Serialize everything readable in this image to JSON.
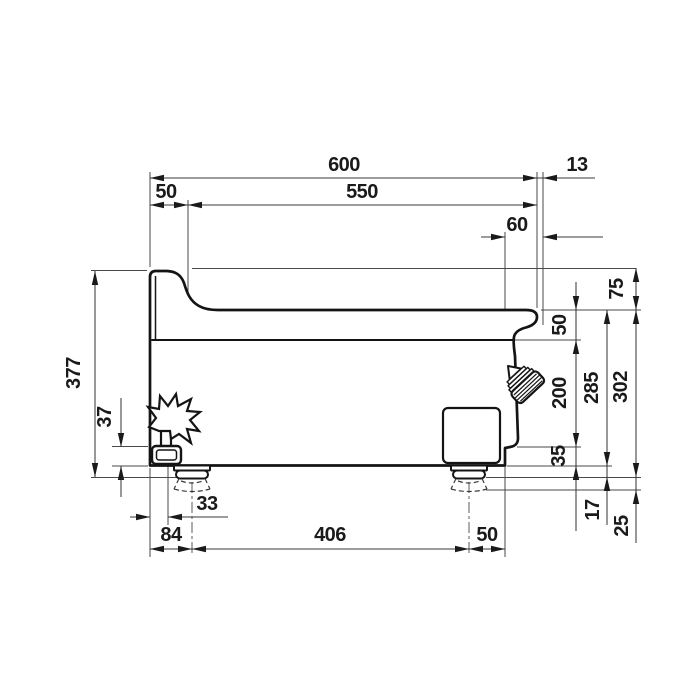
{
  "drawing": {
    "kind": "technical-dimension-side-view",
    "colors": {
      "line": "#141414",
      "thin_line": "#4a4a4a",
      "background": "#ffffff",
      "text": "#1a1a1a"
    },
    "dims": {
      "overall_width": "600",
      "worktop_width": "550",
      "rear_edge_width": "50",
      "knob_protrusion": "13",
      "front_overhang": "60",
      "overall_height": "377",
      "splashback_height": "75",
      "worktop_edge_height": "50",
      "front_panel_height": "200",
      "base_band_height": "35",
      "body_height": "285",
      "height_over_feet": "302",
      "foot_height": "17",
      "foot_adjust_range": "25",
      "gas_fitting_height": "37",
      "gas_center_offset": "33",
      "rear_foot_offset": "84",
      "feet_spacing": "406",
      "front_foot_offset": "50"
    }
  }
}
